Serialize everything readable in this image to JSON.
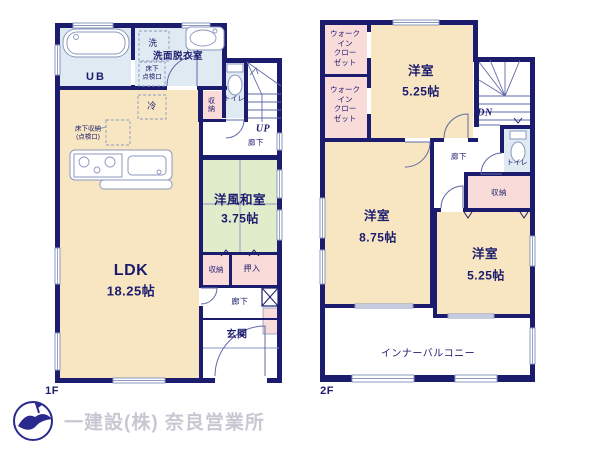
{
  "palette": {
    "wall": "#1c1c6e",
    "room_cream": "#f7e6c1",
    "room_green": "#e0ecca",
    "room_pink": "#f9dbd9",
    "room_blue": "#dfeaf3",
    "line_gray": "#8b98bf",
    "stair_line": "#5f6aa8",
    "logo_text": "#c8c8d2",
    "logo_bird": "#2a2a8e"
  },
  "floor1": {
    "label": "1F",
    "rooms": {
      "ub": "UB",
      "washroom": "洗面脱衣室",
      "washer": "洗",
      "inspection_hatch": "床下\n点検口",
      "fridge": "冷",
      "storage_side": "収納",
      "toilet": "トイレ",
      "stairs_up": "UP",
      "hall_upper": "廊下",
      "underfloor_storage": "床下収納\n(点検口)",
      "ldk_name": "LDK",
      "ldk_size": "18.25帖",
      "washitsu_name": "洋風和室",
      "washitsu_size": "3.75帖",
      "closet": "収納",
      "oshiire": "押入",
      "hall_lower": "廊下",
      "entrance": "玄関"
    }
  },
  "floor2": {
    "label": "2F",
    "rooms": {
      "wic_upper": "ウォーク\nイン\nクロー\nゼット",
      "wic_lower": "ウォーク\nイン\nクロー\nゼット",
      "bedroom_top_name": "洋室",
      "bedroom_top_size": "5.25帖",
      "stairs_down": "DN",
      "toilet": "トイレ",
      "hall": "廊下",
      "closet": "収納",
      "bedroom_mid_name": "洋室",
      "bedroom_mid_size": "8.75帖",
      "bedroom_right_name": "洋室",
      "bedroom_right_size": "5.25帖",
      "balcony": "インナーバルコニー"
    }
  },
  "footer": {
    "company": "一建設(株) 奈良営業所"
  }
}
